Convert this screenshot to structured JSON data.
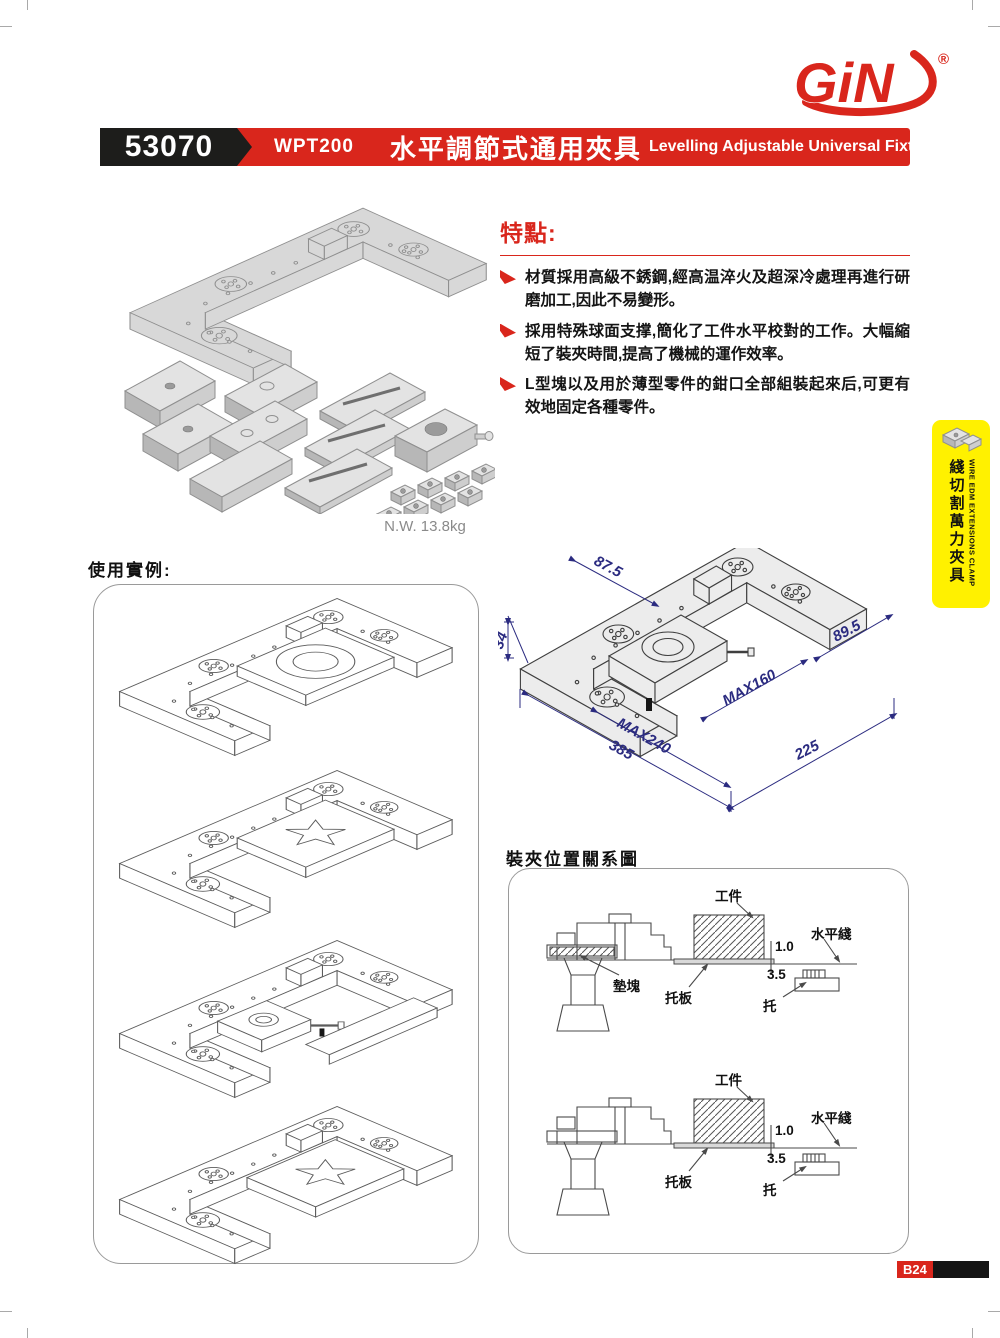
{
  "brand": {
    "logo_text": "GiN",
    "trademark": "®"
  },
  "header": {
    "catalog_no": "53070",
    "model": "WPT200",
    "title_zh": "水平調節式通用夾具",
    "title_en": "Levelling Adjustable Universal Fixture"
  },
  "features": {
    "heading": "特點:",
    "items": [
      "材質採用高級不銹鋼,經高温淬火及超深冷處理再進行研磨加工,因此不易變形。",
      "採用特殊球面支撑,簡化了工件水平校對的工作。大幅縮短了裝夾時間,提高了機械的運作效率。",
      "L型塊以及用於薄型零件的鉗口全部組裝起來后,可更有效地固定各種零件。"
    ]
  },
  "product": {
    "net_weight": "N.W. 13.8kg"
  },
  "usage_examples": {
    "heading": "使用實例:"
  },
  "tech_drawing": {
    "dims": {
      "w875": "87.5",
      "h34": "34",
      "w895": "89.5",
      "max160": "MAX160",
      "max240": "MAX240",
      "total385": "385",
      "len225": "225"
    }
  },
  "clamping_diagram": {
    "heading": "裝夾位置關系圖",
    "labels": {
      "workpiece": "工件",
      "level_line": "水平綫",
      "gap_top": "1.0",
      "gap_bottom": "3.5",
      "pad_block": "墊塊",
      "support_plate": "托板",
      "support": "托"
    }
  },
  "side_tab": {
    "en": "WIRE EDM EXTENSIONS CLAMP",
    "zh": "綫切割萬力夾具"
  },
  "footer": {
    "page_no": "B24"
  }
}
